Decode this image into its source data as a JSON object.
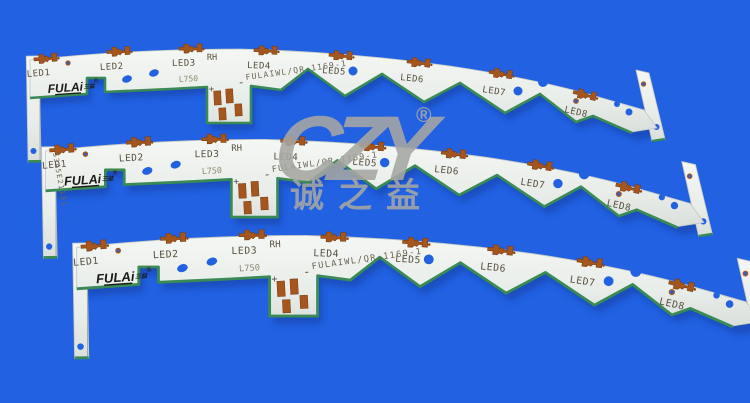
{
  "colors": {
    "background": "#2161e2",
    "board_face": "#e9ede9",
    "board_face_light": "#f4f7f3",
    "board_shadow_edge": "#d6dcd8",
    "edge_green": "#3a8a55",
    "copper": "#a4561e",
    "silkscreen": "#57503f",
    "hole_blue": "#2161e2",
    "watermark_gray": "#a6a7a3"
  },
  "watermark": {
    "logo_text": "CZY",
    "registered_mark": "®",
    "brand_name": "诚之益"
  },
  "pcb": {
    "brand_logo": "FULAi",
    "brand_logo_suffix": "三益",
    "brand_registered": "®",
    "led_labels": [
      "LED1",
      "LED2",
      "LED3",
      "LED4",
      "LED5",
      "LED6",
      "LED7",
      "LED8"
    ],
    "marking_rh": "RH",
    "marking_length": "L750",
    "part_number": "FULAIWL/QR-1169-1",
    "polarity_positive": "+",
    "polarity_negative": "-",
    "serial_number": "5345E21191"
  }
}
